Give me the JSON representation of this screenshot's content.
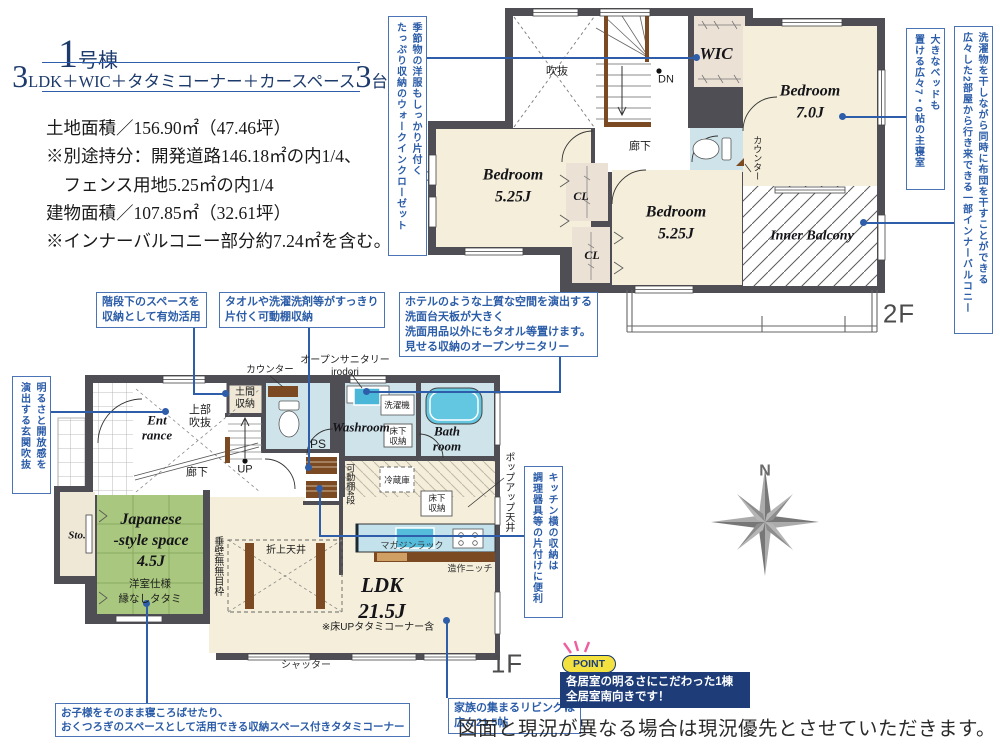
{
  "header": {
    "unit_big": "1",
    "unit_suffix": "号棟",
    "plan_big1": "3",
    "plan_mid": "LDK＋WIC＋タタミコーナー＋カースペース",
    "plan_big2": "3",
    "plan_tail": "台",
    "spec_lines": [
      "土地面積／156.90㎡（47.46坪）",
      "※別途持分：開発道路146.18㎡の内1/4、",
      "　フェンス用地5.25㎡の内1/4",
      "建物面積／107.85㎡（32.61坪）",
      "※インナーバルコニー部分約7.24㎡を含む。"
    ]
  },
  "plan2f": {
    "void": "吹抜",
    "dn": "DN",
    "wic": "WIC",
    "hallway": "廊下",
    "counter": "カウンター",
    "bedroom7": "Bedroom\n7.0J",
    "bedroom525_left": "Bedroom\n5.25J",
    "cl1": "CL",
    "cl2": "CL",
    "bedroom525_right": "Bedroom\n5.25J",
    "inner_balcony": "Inner Balcony",
    "floor_label": "2F"
  },
  "plan1f": {
    "entrance": "Ent\nrance",
    "upper_void": "上部\n吹抜",
    "doma_storage": "土間\n収納",
    "hallway": "廊下",
    "up": "UP",
    "counter": "カウンター",
    "open_sanitary": "オープンサニタリー\nirodori",
    "ps": "PS",
    "movable_shelf": "可動棚4段",
    "washroom": "Washroom",
    "washer": "洗濯機",
    "underfloor_wash": "床下\n収納",
    "bathroom": "Bath\nroom",
    "fridge": "冷蔵庫",
    "underfloor_kitchen": "床下\n収納",
    "popup_ceiling": "ポップアップ天井",
    "magazine_rack": "マガジンラック",
    "niche": "造作ニッチ",
    "ldk": "LDK\n21.5J",
    "ldk_note": "※床UPタタミコーナー含",
    "coffered_ceiling": "折上天井",
    "wall_note": "垂壁無無目枠",
    "japanese_room": "Japanese\n-style space\n4.5J",
    "japanese_room_sub": "洋室仕様\n縁なしタタミ",
    "storage": "Sto.",
    "shutter": "シャッター",
    "floor_label": "1F"
  },
  "callouts": {
    "wic": "季節物の洋服もしっかり片付く\nたっぷり収納のウォークインクローゼット",
    "master": "大きなベッドも\n置ける広々7・0帖の主寝室",
    "balcony": "洗濯物を干しながら同時に布団を干すことができる\n広々した2部屋から行き来できる一部インナーバルコニー",
    "genkan_void": "明るさと開放感を\n演出する玄関吹抜",
    "under_stairs": "階段下のスペースを\n収納として有効活用",
    "towel": "タオルや洗濯洗剤等がすっきり\n片付く可動棚収納",
    "sanitary": "ホテルのような上質な空間を演出する\n洗面台天板が大きく\n洗面用品以外にもタオル等置けます。\n見せる収納のオープンサニタリー",
    "kitchen_storage": "キッチン横の収納は\n調理器具等の片付けに便利",
    "tatami": "お子様をそのまま寝ころばせたり、\nおくつろぎのスペースとして活用できる収納スペース付きタタミコーナー",
    "living": "家族の集まるリビングは\n広々21.5帖"
  },
  "point": {
    "badge": "POINT",
    "text": "各居室の明るさにこだわった1棟\n全居室南向きです！"
  },
  "compass": {
    "north": "N"
  },
  "disclaimer": "図面と現況が異なる場合は現況優先とさせていただきます。",
  "colors": {
    "accent_blue": "#2e5ea9",
    "navy": "#1c3a6b",
    "wall": "#504e55",
    "tatami_green": "#a9c77e",
    "wet_blue": "#cfe4ea",
    "cream": "#f4eeda",
    "wood": "#7b4a22",
    "point_navy": "#1d3c78",
    "point_yellow": "#f3e140",
    "ray_pink": "#ef5fa0"
  }
}
